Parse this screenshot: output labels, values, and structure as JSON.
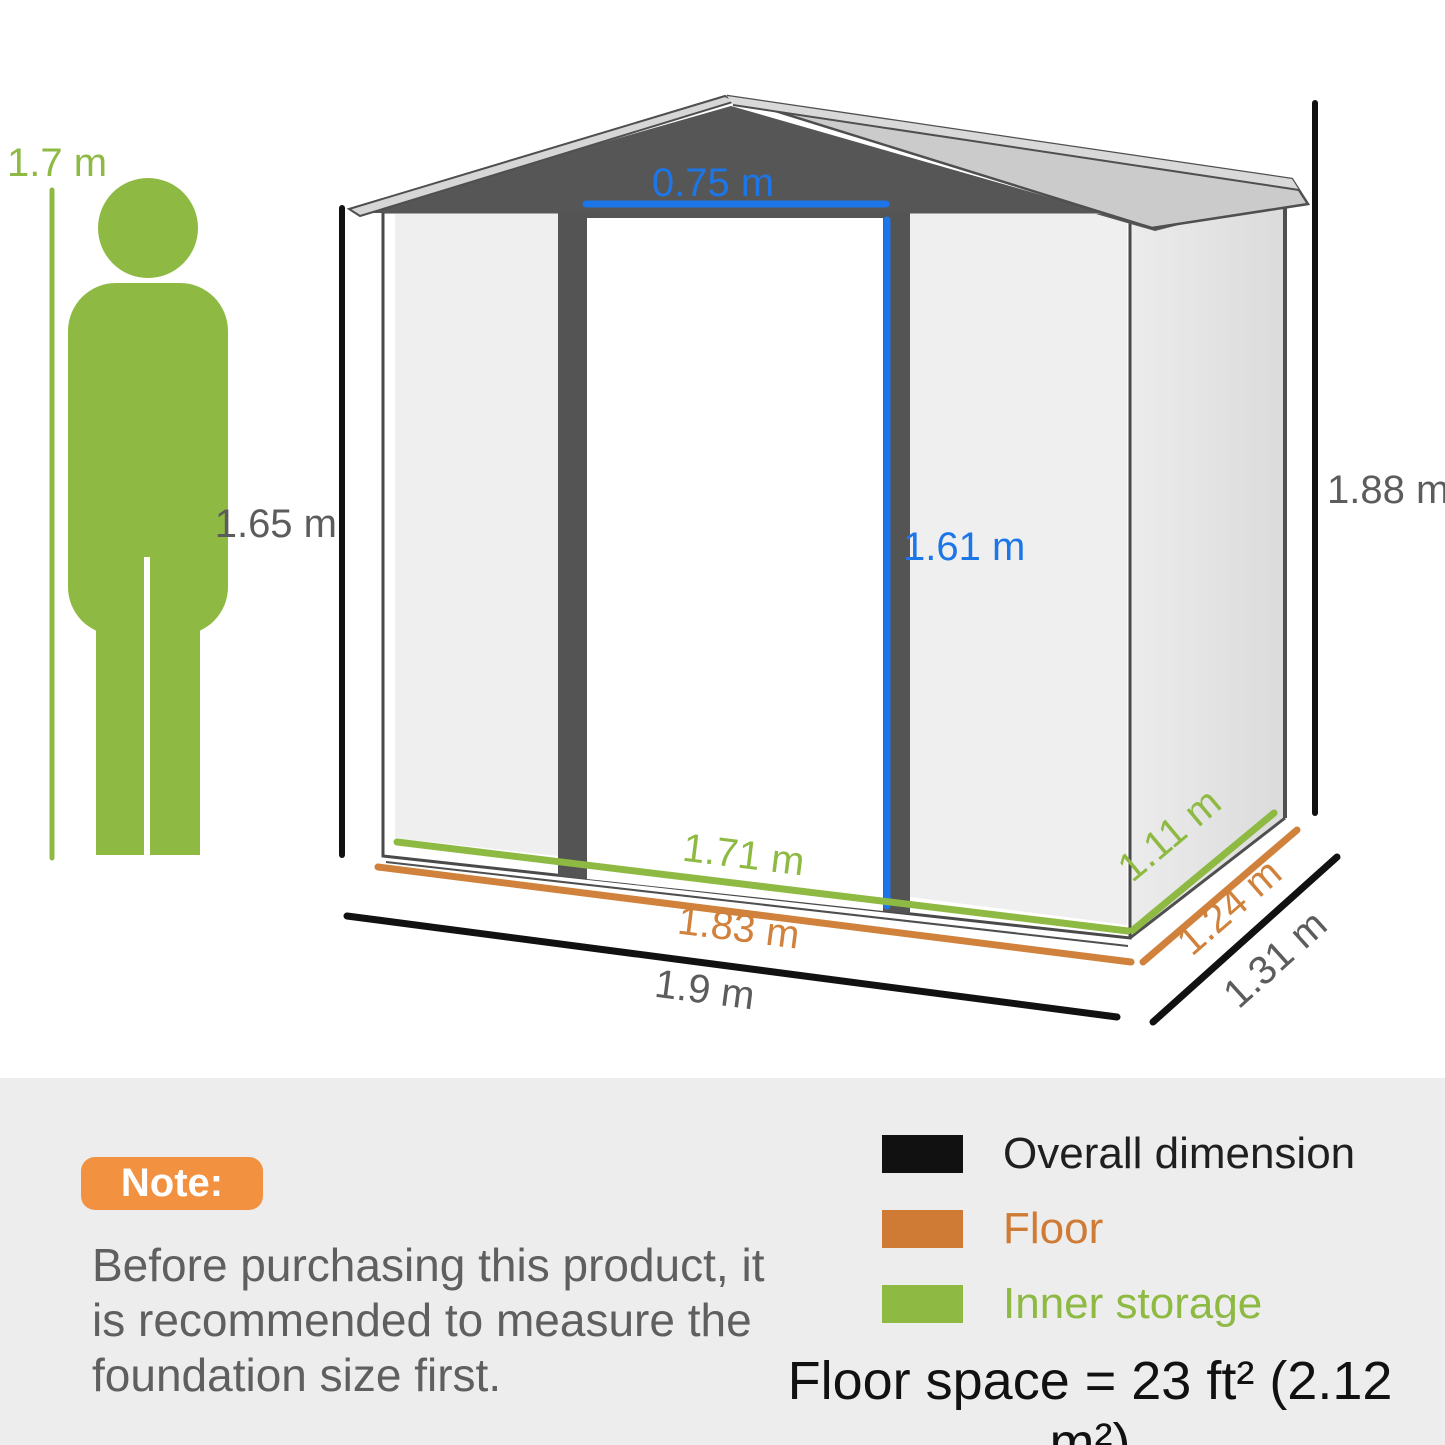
{
  "dimensions": {
    "person_height": "1.7 m",
    "inner_height": "1.65 m",
    "overall_height": "1.88 m",
    "door_width": "0.75 m",
    "door_height": "1.61 m",
    "inner_width": "1.71 m",
    "floor_width": "1.83 m",
    "overall_width": "1.9 m",
    "inner_depth": "1.11 m",
    "floor_depth": "1.24 m",
    "overall_depth": "1.31 m"
  },
  "note": {
    "badge": "Note:",
    "line1": "Before purchasing this product, it",
    "line2": "is recommended to measure the",
    "line3": "foundation size first."
  },
  "legend": {
    "items": [
      {
        "label": "Overall dimension",
        "color": "#111111"
      },
      {
        "label": "Floor",
        "color": "#cf7a35"
      },
      {
        "label": "Inner storage",
        "color": "#8eba43"
      }
    ],
    "floor_space": "Floor space = 23 ft² (2.12 m²)"
  },
  "colors": {
    "accent_green": "#8eba43",
    "accent_orange": "#cf7a35",
    "accent_blue": "#1c76e8",
    "shed_dark_gray": "#545454",
    "dimension_text_gray": "#5c5c5c",
    "note_badge_orange": "#f29140",
    "bottom_band_bg": "#ededed"
  }
}
